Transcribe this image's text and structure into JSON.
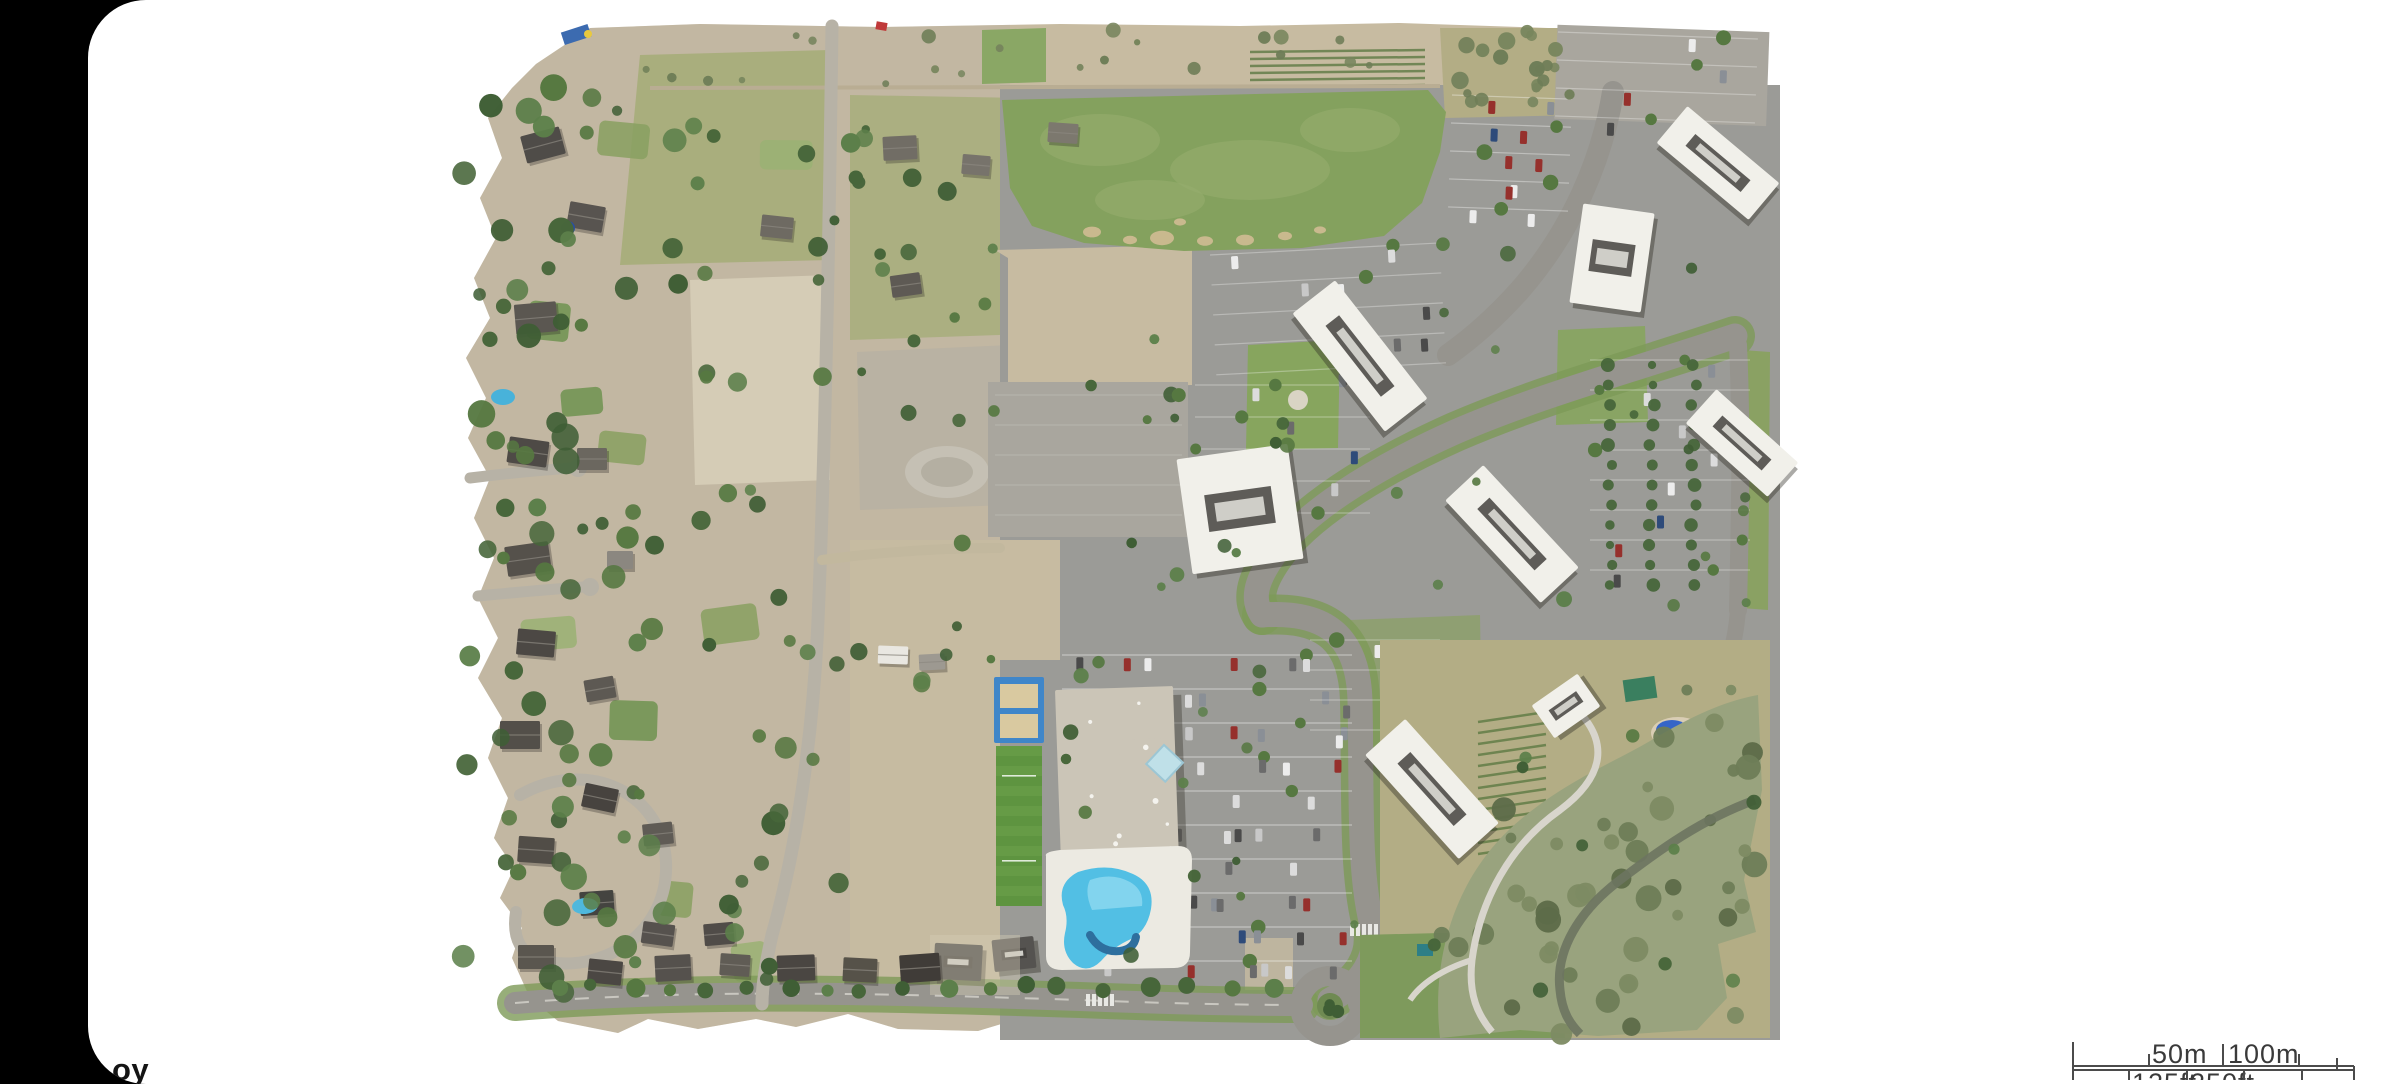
{
  "ui": {
    "background": "#000000",
    "panel_color": "#ffffff",
    "scale_text_color": "#3a3a3a",
    "scale_line_color": "#4b4b4b",
    "watermark_color": "#141414"
  },
  "watermark": {
    "visible_text": "oy"
  },
  "scale_bar": {
    "metric_labels": [
      "50m",
      "100m"
    ],
    "imperial_labels": [
      "125ft",
      "250ft"
    ]
  },
  "map": {
    "type": "aerial-orthomosaic",
    "description": "Drone orthomosaic of a suburban area: residential neighborhood on the west, large grass field to the north, office campus with white-roofed buildings and parking lots to the east, recreation center with outdoor pool at center-south, creek corridor park at the southeast",
    "features": [
      "residential-neighborhood",
      "grass-field",
      "office-campus",
      "parking-lots",
      "recreation-center",
      "swimming-pool",
      "volleyball-courts",
      "soccer-field",
      "creek-corridor",
      "playground",
      "roundabout",
      "roads"
    ],
    "palette": {
      "dirt": "#c7bba1",
      "dirt_light": "#d5ccb6",
      "dirt_gray": "#b9b2a3",
      "grass_field": "#84a15e",
      "grass_light": "#96ae6e",
      "grass_park": "#7e9a5c",
      "grass_dry": "#b3ad85",
      "meadow": "#a9ae7d",
      "asphalt": "#9b9b97",
      "asphalt_light": "#a9a69e",
      "road": "#96948e",
      "road_rural": "#b7b2a6",
      "trail": "#d8d5cc",
      "roof_white": "#f1f0ea",
      "roof_rec": "#cbc5b7",
      "roof_dark": "#504c48",
      "roof_unit": "#44423e",
      "tree_dark": "#47663a",
      "tree_mid": "#567841",
      "tree_olive": "#6e7d57",
      "sage": "#99a37e",
      "pool_blue": "#52bfe4",
      "pool_light": "#8fd9f0",
      "court_blue": "#3f86c9",
      "sand": "#d9c9a0",
      "water": "#6d7461",
      "playground_blue": "#3565c8",
      "pavilion_green": "#3a7f5f",
      "pavilion_teal": "#2e7f86",
      "skylight": "#bfe0e8",
      "marking_red": "#c03a3a",
      "soccer_green": "#5e9440",
      "stall_line": "#ffffff"
    }
  }
}
